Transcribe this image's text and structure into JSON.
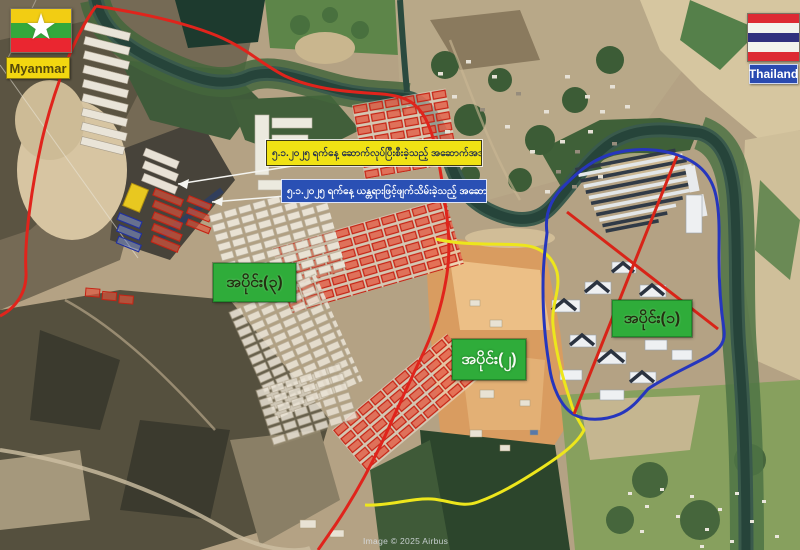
{
  "attribution": "Image © 2025 Airbus",
  "flags": {
    "myanmar": {
      "label": "Myanmar"
    },
    "thailand": {
      "label": "Thailand"
    }
  },
  "icons": {
    "myanmar_star": "★"
  },
  "callouts": {
    "photo_label": {
      "text": "၅.၁.၂၀၂၅ ရက်နေ့ ဆောက်လုပ်ပြီးစီးခဲ့သည့် အဆောက်အအုံများ",
      "bg": "#f0e214",
      "fg": "#1c2a50"
    },
    "machine_label": {
      "text": "၅.၁.၂၀၂၅ ရက်နေ့ ယန္တရားဖြင့်ဖျက်သိမ်းခဲ့သည့် အဆောက်အအုံများ",
      "bg": "#2a50b4",
      "fg": "#ffffff"
    }
  },
  "sections": {
    "section3": {
      "label": "အပိုင်း(၃)",
      "boundary_color": "#e0241c"
    },
    "section2": {
      "label": "အပိုင်း(၂)",
      "boundary_color": "#ede61c"
    },
    "section1": {
      "label": "အပိုင်း(၁)",
      "boundary_color": "#2636bd"
    }
  },
  "colors": {
    "section_label_bg": "#2fac3a",
    "myanmar_label_bg": "#f2d710",
    "thailand_label_bg": "#2a4ab0",
    "river": "#2a4a3e"
  }
}
